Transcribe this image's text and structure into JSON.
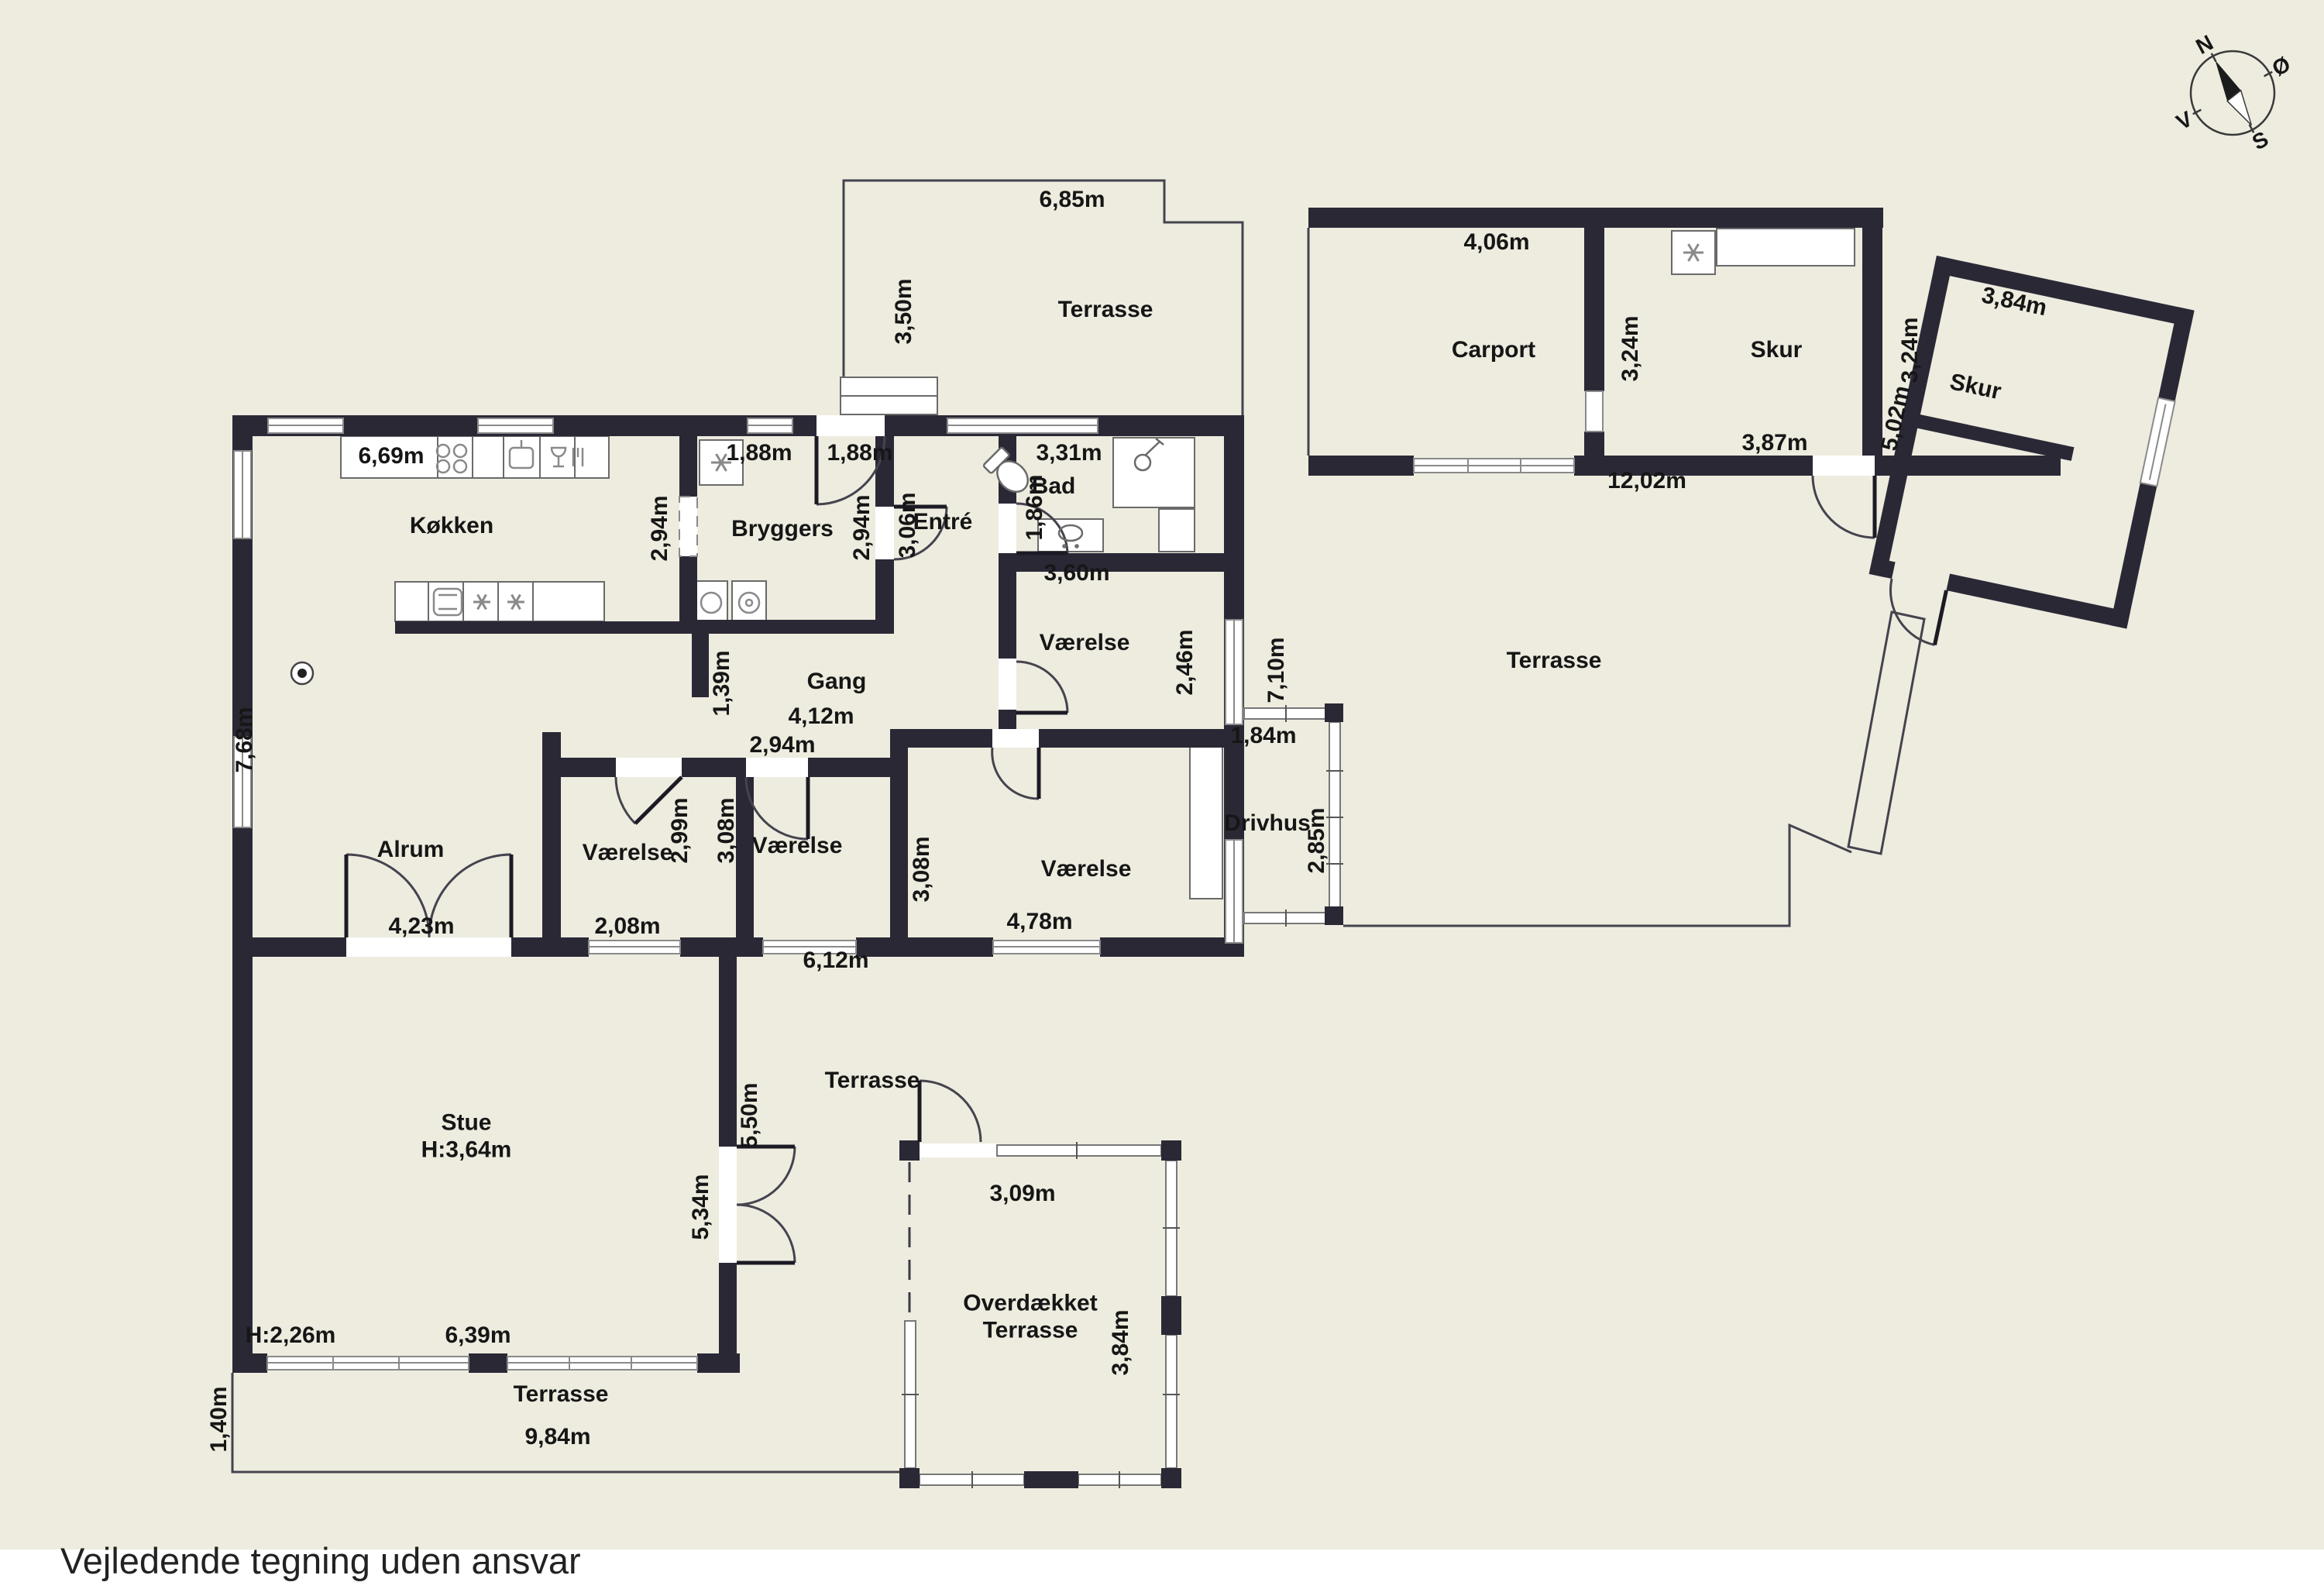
{
  "disclaimer": "Vejledende tegning uden ansvar",
  "compass": {
    "n": "N",
    "e": "Ø",
    "s": "S",
    "w": "V"
  },
  "rooms": [
    "Terrasse",
    "Carport",
    "Skur",
    "Skur",
    "Terrasse",
    "Køkken",
    "Bryggers",
    "Entré",
    "Bad",
    "Værelse",
    "Gang",
    "Alrum",
    "Værelse",
    "Værelse",
    "Værelse",
    "Drivhus",
    "Stue\nH:3,64m",
    "Terrasse",
    "Overdækket\nTerrasse",
    "Terrasse"
  ],
  "dims": [
    "6,85m",
    "3,50m",
    "4,06m",
    "3,24m",
    "3,87m",
    "3,24m",
    "12,02m",
    "3,84m",
    "5,02m",
    "6,69m",
    "1,88m",
    "1,88m",
    "3,31m",
    "2,94m",
    "2,94m",
    "3,06m",
    "1,86m",
    "3,60m",
    "2,46m",
    "7,10m",
    "7,68m",
    "1,39m",
    "4,12m",
    "2,94m",
    "2,99m",
    "3,08m",
    "3,08m",
    "1,84m",
    "2,85m",
    "4,23m",
    "2,08m",
    "6,12m",
    "4,78m",
    "5,50m",
    "5,34m",
    "H:2,26m",
    "6,39m",
    "3,09m",
    "3,84m",
    "1,40m",
    "9,84m"
  ]
}
